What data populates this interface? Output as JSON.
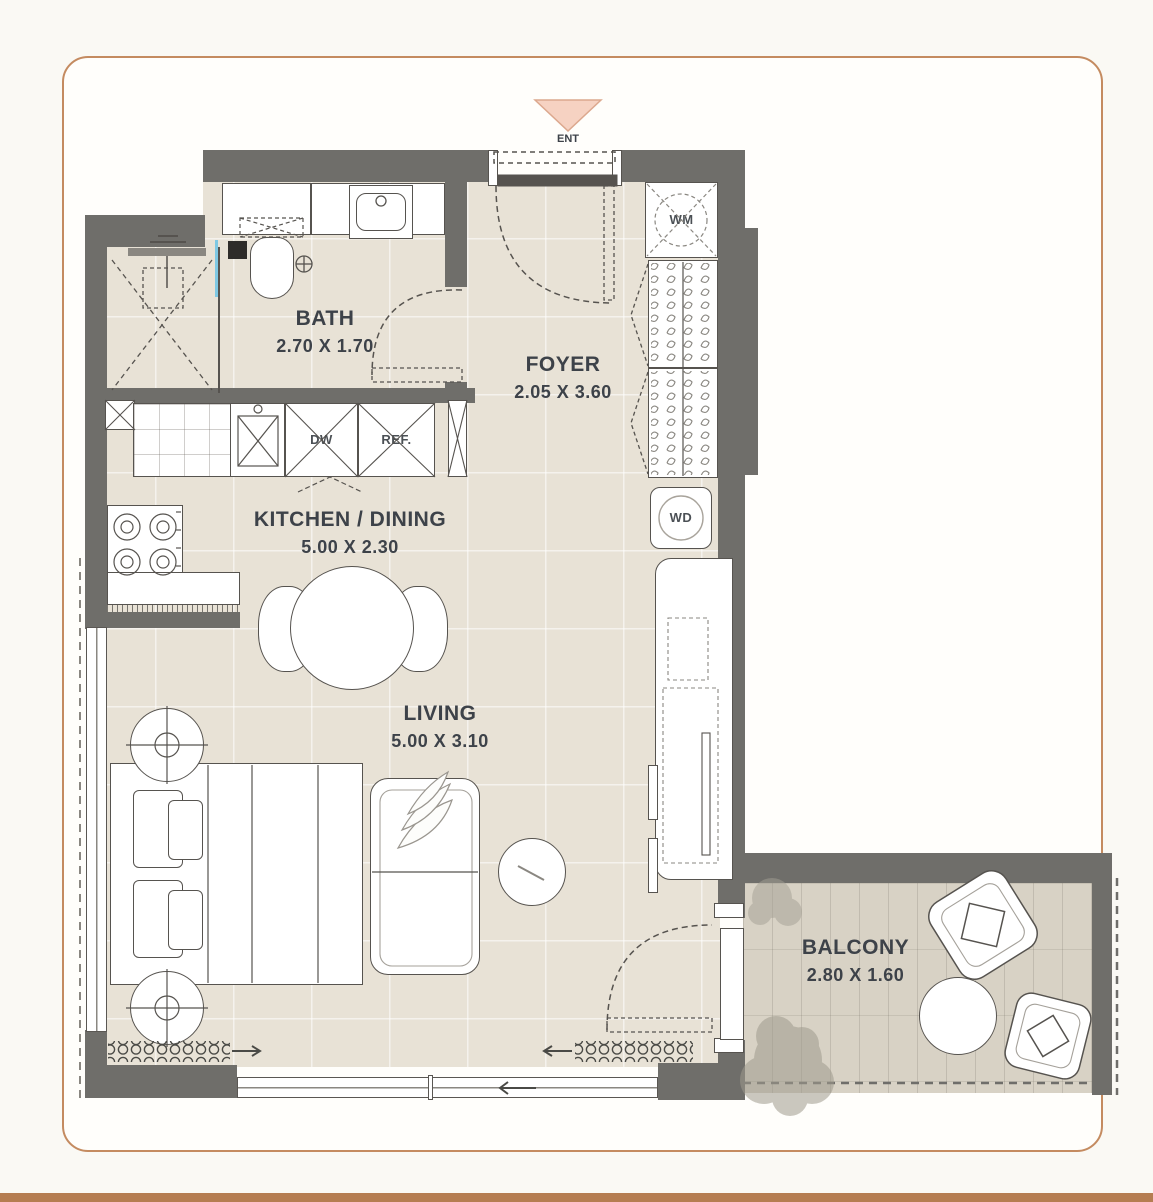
{
  "page": {
    "frame_color": "#c48b60",
    "footer_bar_color": "#b57d51",
    "background": "#faf9f4"
  },
  "plan": {
    "entrance": {
      "label": "ENT",
      "marker_color": "#f6d2c2"
    },
    "rooms": [
      {
        "id": "bath",
        "name": "BATH",
        "dims": "2.70 X 1.70"
      },
      {
        "id": "foyer",
        "name": "FOYER",
        "dims": "2.05 X 3.60"
      },
      {
        "id": "kitchen",
        "name": "KITCHEN / DINING",
        "dims": "5.00 X 2.30"
      },
      {
        "id": "living",
        "name": "LIVING",
        "dims": "5.00 X 3.10"
      },
      {
        "id": "balcony",
        "name": "BALCONY",
        "dims": "2.80 X 1.60"
      }
    ],
    "appliances": {
      "washing_machine": "WM",
      "washer_dryer": "WD",
      "dishwasher": "DW",
      "refrigerator": "REF."
    },
    "colors": {
      "wall": "#6f6e6a",
      "floor_tile": "#e8e2d6",
      "balcony_floor": "#d8d2c5",
      "shower_glass": "#7ec8e3",
      "line": "#56534f"
    }
  }
}
